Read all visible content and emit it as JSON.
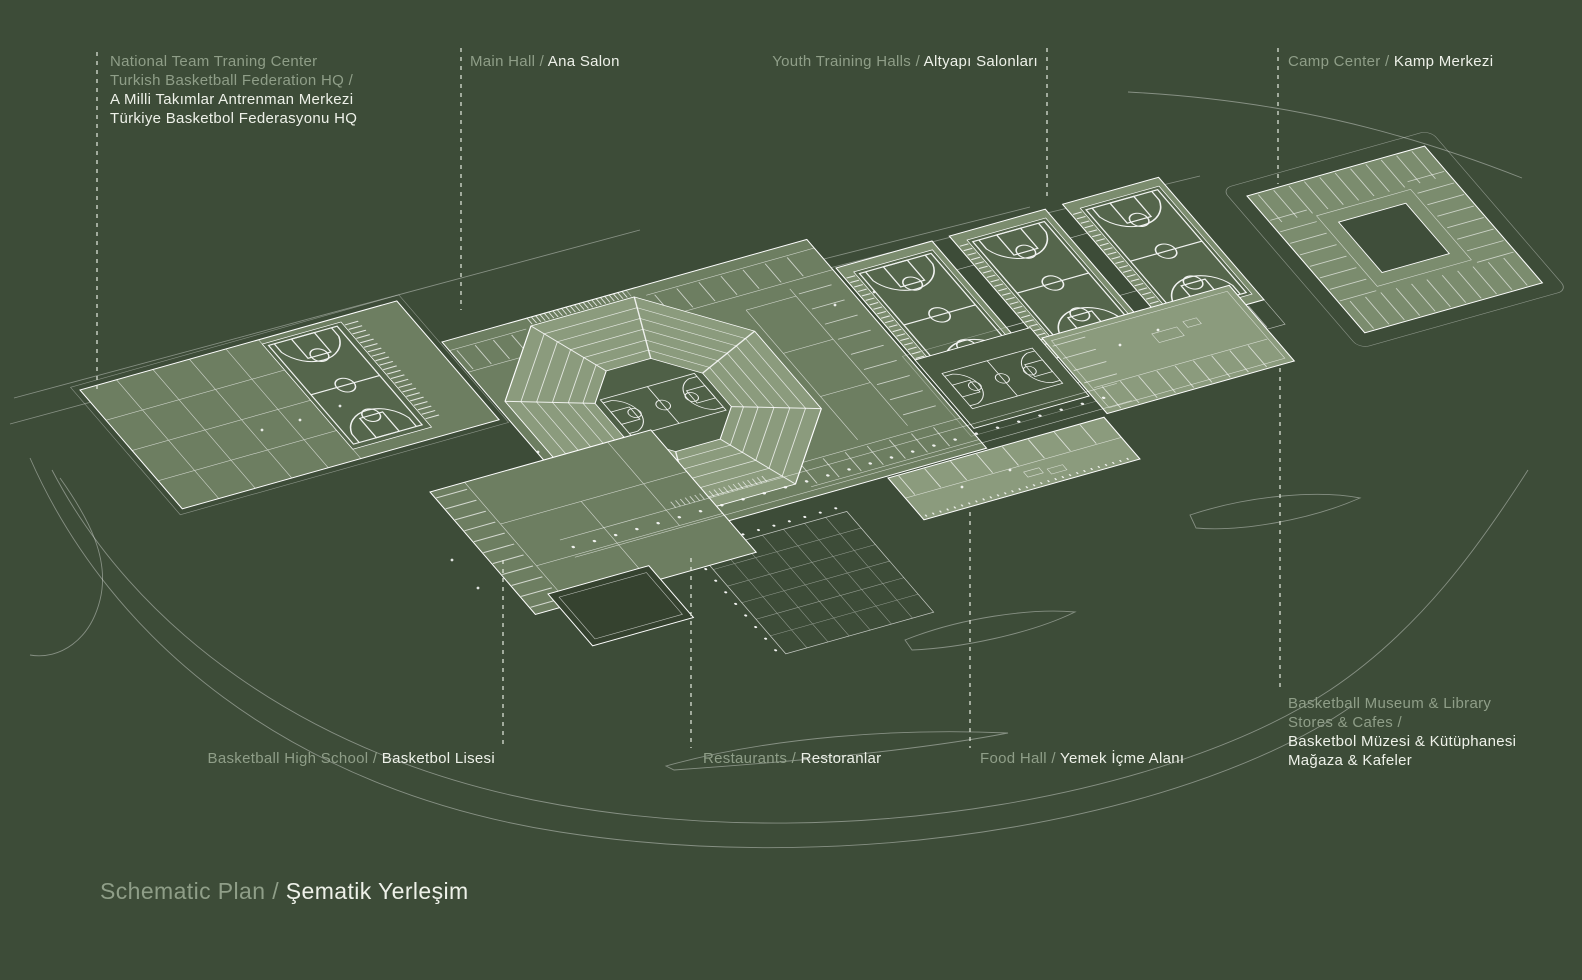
{
  "title": {
    "muted": "Schematic Plan /",
    "bright": "Şematik Yerleşim"
  },
  "labels": {
    "national_team": {
      "line1": "National Team Traning Center",
      "line2": "Turkish Basketball Federation HQ /",
      "line3": "A Milli Takımlar Antrenman Merkezi",
      "line4": "Türkiye Basketbol Federasyonu HQ"
    },
    "main_hall": {
      "muted": "Main Hall /",
      "bright": "Ana Salon"
    },
    "youth_halls": {
      "muted": "Youth Training Halls /",
      "bright": "Altyapı Salonları"
    },
    "camp_center": {
      "muted": "Camp Center /",
      "bright": "Kamp Merkezi"
    },
    "high_school": {
      "muted": "Basketball High School /",
      "bright": "Basketbol Lisesi"
    },
    "restaurants": {
      "muted": "Restaurants /",
      "bright": "Restoranlar"
    },
    "food_hall": {
      "muted": "Food Hall /",
      "bright": "Yemek İçme Alanı"
    },
    "museum": {
      "line1": "Basketball Museum & Library",
      "line2": "Stores & Cafes /",
      "line3": "Basketbol Müzesi & Kütüphanesi",
      "line4": "Mağaza & Kafeler"
    }
  },
  "colors": {
    "background": "#3d4c38",
    "linework": "#ffffff",
    "muted_text": "#8f9e88",
    "bright_text": "#eef1e9",
    "light_slab": "#8b9b7d",
    "mid_slab": "#6d7e61",
    "court_fill": "#4f6047"
  }
}
